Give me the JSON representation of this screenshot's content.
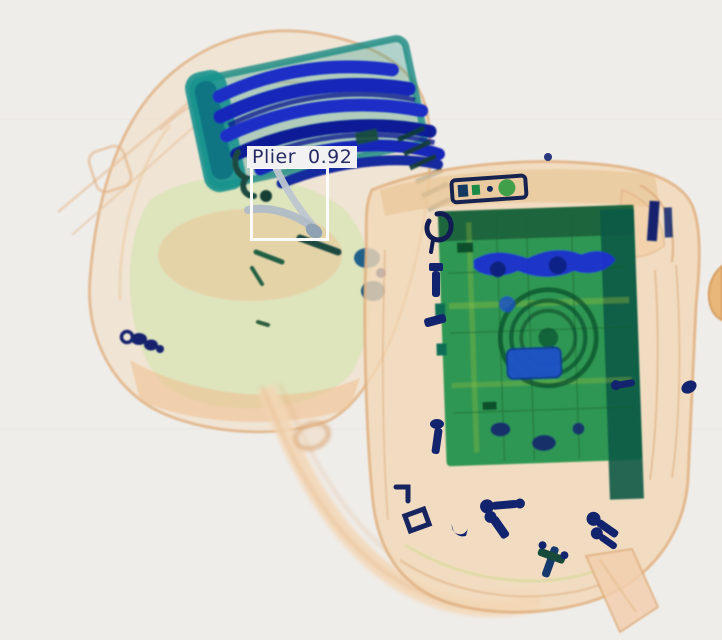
{
  "scene": {
    "type": "x-ray baggage security scan",
    "objects": [
      "left-backpack",
      "right-backpack",
      "pliers",
      "coiled-cable-bundle",
      "laptop-electronics",
      "flashlight",
      "bolts-and-fasteners",
      "shoulder-strap"
    ]
  },
  "detection": {
    "label": "Plier",
    "confidence": "0.92",
    "box": {
      "x": 250,
      "y": 166,
      "width": 79,
      "height": 75
    },
    "label_offset": {
      "x": 247,
      "y": 146,
      "height": 22
    }
  },
  "colors": {
    "background": "#efedea",
    "bag_tan": "#f3d8b6",
    "bag_tan_light": "#f6e3cb",
    "bag_edge": "#e0b183",
    "bag_deep": "#dfa06a",
    "green_wash": "#d9e4b8",
    "metal_blue": "#1a2ec6",
    "metal_blue_dark": "#0e1d90",
    "metal_navy": "#13246e",
    "teal": "#17928e",
    "dark_teal": "#1c4a40",
    "laptop_green": "#1f9149",
    "laptop_dark": "#0e5c2d",
    "item_blue": "#1b50c8",
    "plier_gray": "#bcc6cf",
    "detection_box": "#fbfbfb",
    "label_background": "#f2f2f2",
    "label_text": "#262b66"
  }
}
